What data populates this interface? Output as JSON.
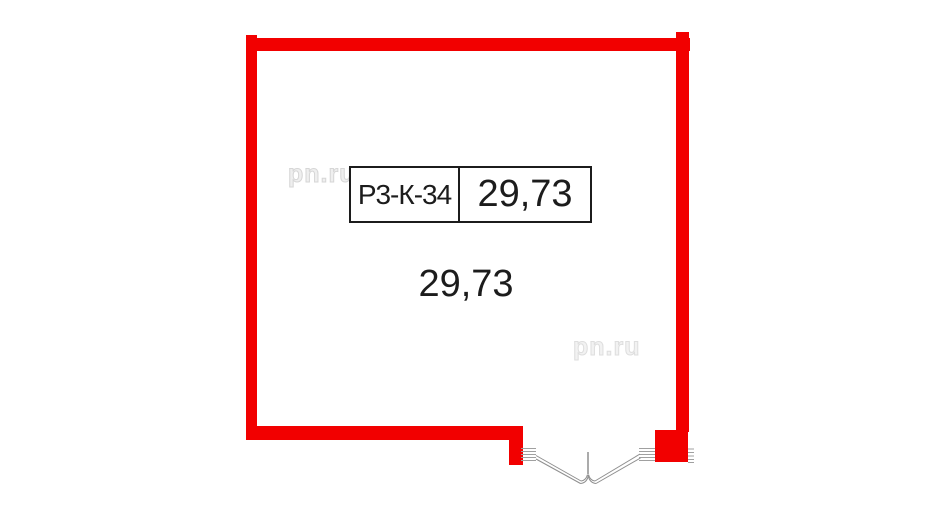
{
  "plan": {
    "unit_box": {
      "code": "Р3-К-34",
      "area": "29,73"
    },
    "room": {
      "area": "29,73"
    },
    "watermark": {
      "text": "pn.ru"
    },
    "colors": {
      "wall_red": "#f20000",
      "outline_black": "#1c1c1c",
      "door_gray": "#8f8f8f",
      "watermark_gray": "#d6d6d6"
    }
  }
}
